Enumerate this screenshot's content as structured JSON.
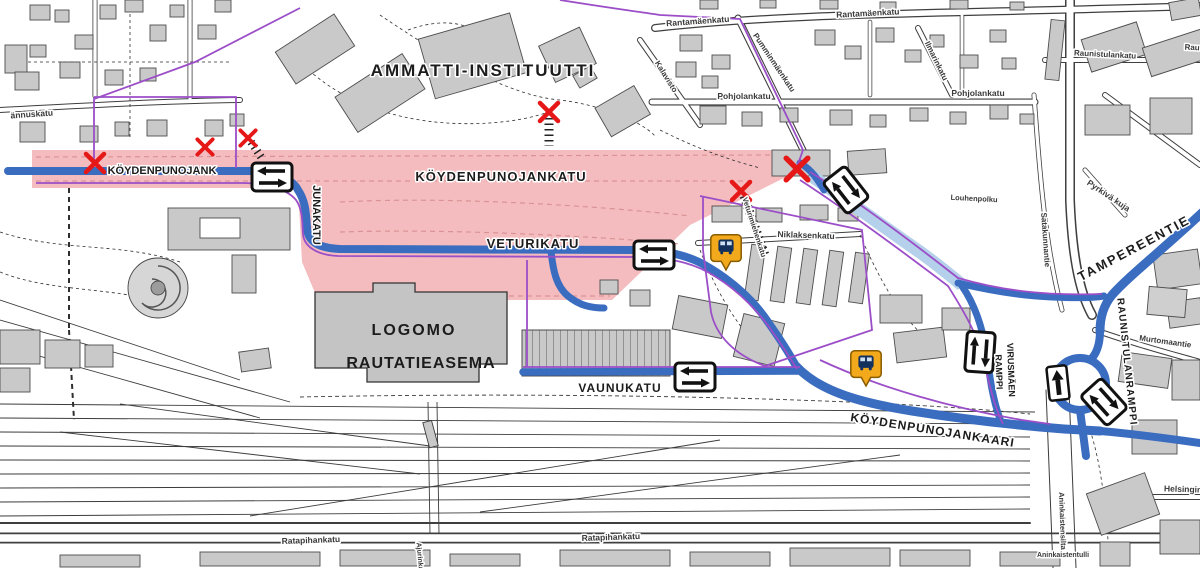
{
  "map": {
    "title": "Street works map — Logomo / railway station area",
    "labels": {
      "ammatti_instituutti": "AMMATTI-INSTITUUTTI",
      "koydenpunojank": "KÖYDENPUNOJANK",
      "koydenpunojankatu": "KÖYDENPUNOJANKATU",
      "junakatu": "JUNAKATU",
      "veturikatu": "VETURIKATU",
      "logomo": "LOGOMO",
      "rautatieasema": "RAUTATIEASEMA",
      "vaunukatu": "VAUNUKATU",
      "koydenpunojankaari": "KÖYDENPUNOJANKAARI",
      "tampereentie": "TAMPEREENTIE",
      "raunistulanramppi": "RAUNISTULANRAMPPI",
      "virusmaen": "VIRUSMÄEN",
      "ramppi": "RAMPPI",
      "rantamaenkatu": "Rantamäenkatu",
      "pohjolankatu": "Pohjolankatu",
      "kalavisto": "Kalavisto",
      "pumminmaenkatu": "Pumminmäenkatu",
      "ilmarinkatu": "Ilmarinkatu",
      "raunistulankatu": "Raunistulankatu",
      "rau_fragment": "Rau",
      "niklaksenkatu": "Niklaksenkatu",
      "veturimiehenkatu": "Veturimiehenkatu",
      "louhenpolku": "Louhenpolku",
      "satakunnantie": "Satakunnantie",
      "pyrkiva_kuja": "Pyrkivä kuja",
      "murtomaantie": "Murtomaantie",
      "helsingin": "Helsingin",
      "aninkaistensilta": "Aninkaistensilta",
      "aninkaistentulli": "Aninkaistentulli",
      "ratapihankatu": "Ratapihankatu",
      "annuskatu": "ännuskatu",
      "ajurinkatu": "Ajurinkatu"
    },
    "icons": {
      "road_closure": "red-x-mark",
      "bus_stop": "orange-bus-pin",
      "two_way_traffic_sign": "white-plate-double-arrow",
      "one_way_traffic_sign": "white-plate-single-arrow"
    },
    "symbol_counts": {
      "road_closures": 6,
      "bus_stops": 2,
      "two_way_signs": 5,
      "one_way_signs": 1
    },
    "colors": {
      "works_area_pink": "#f4bcbe",
      "main_route_blue": "#3a6cc0",
      "secondary_route_pale_blue": "#b5d0ea",
      "cycle_route_purple": "#9b4ec8",
      "closure_red": "#e61717",
      "bus_orange": "#f2a91c",
      "building_grey": "#c9c9c9"
    }
  }
}
